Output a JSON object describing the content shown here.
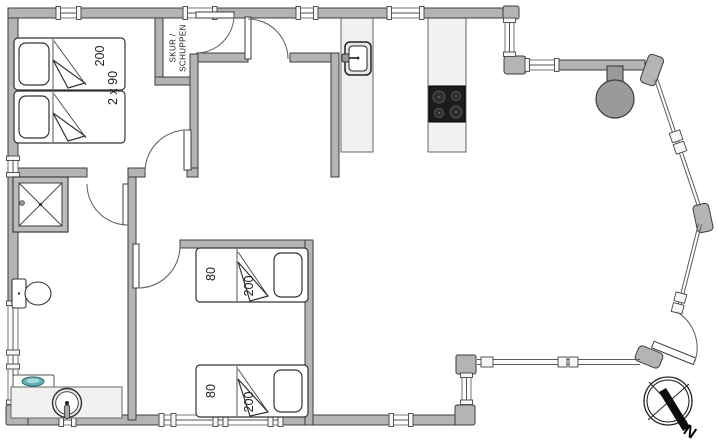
{
  "floorplan": {
    "shed": {
      "label_line1": "SKUR /",
      "label_line2": "SCHUPPEN"
    },
    "bedroom_main": {
      "bed_length_label": "200",
      "bed_width_label": "2 x 90"
    },
    "bedroom_twin": {
      "bed_top": {
        "width_label": "80",
        "length_label": "200"
      },
      "bed_bottom": {
        "width_label": "80",
        "length_label": "200"
      }
    },
    "compass": {
      "north_label": "N"
    },
    "colors": {
      "wall_fill": "#b4b4b4",
      "wall_outline": "#3d3d3d",
      "counter_fill": "#f1f1ef",
      "cooktop_fill": "#1b1b1b",
      "stove_fill": "#9a9a9a",
      "basin_teal": "#63b1b5"
    }
  }
}
